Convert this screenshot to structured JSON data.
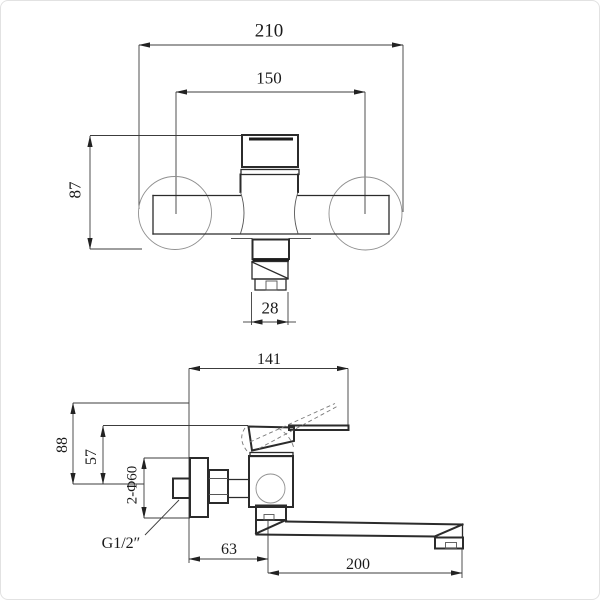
{
  "drawing": {
    "type": "technical dimensional drawing of wall-mounted mixer faucet, two views",
    "colors": {
      "line": "#2b2b2b",
      "thin_line": "#8f8f8f",
      "background": "#ffffff",
      "border": "#e2e2e2"
    },
    "front_view": {
      "overall_width": "210",
      "inlet_center_distance": "150",
      "body_height": "87",
      "outlet_width": "28"
    },
    "side_view": {
      "handle_reach": "141",
      "open_handle_height": "88",
      "closed_handle_height": "57",
      "flange_spec": "2-Φ60",
      "thread_spec": "G1/2″",
      "wall_to_axis": "63",
      "spout_length": "200"
    }
  }
}
